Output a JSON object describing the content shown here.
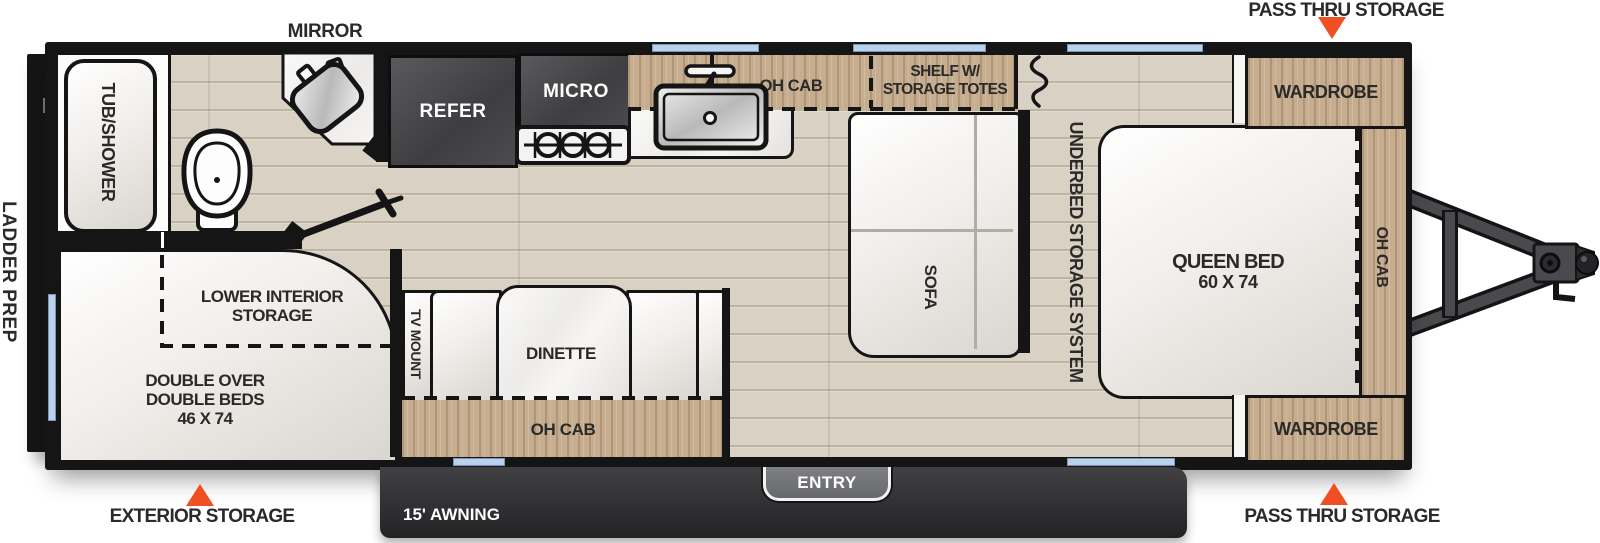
{
  "colors": {
    "accent_orange": "#F04E23",
    "window_blue": "#B9D3EE",
    "wall_black": "#151515",
    "floor_wood": "#D9D1C3",
    "cabinet_wood": "#C6AD90",
    "appliance_dark": "#4A4A4D",
    "awning_dark": "#39393C",
    "furniture_white": "#F6F4F2",
    "label_text": "#2B2A29"
  },
  "exterior": {
    "mirror_label": "MIRROR",
    "pass_thru_top_label": "PASS THRU STORAGE",
    "pass_thru_bottom_label": "PASS THRU STORAGE",
    "exterior_storage_label": "EXTERIOR STORAGE",
    "ladder_prep_label": "LADDER PREP",
    "awning_label": "15' AWNING",
    "entry_label": "ENTRY"
  },
  "interior": {
    "tub_shower": "TUB/SHOWER",
    "refer": "REFER",
    "micro": "MICRO",
    "kitchen_oh_cab": "OH CAB",
    "shelf_line1": "SHELF W/",
    "shelf_line2": "STORAGE TOTES",
    "sofa": "SOFA",
    "underbed_storage": "UNDERBED STORAGE SYSTEM",
    "queen_bed_line1": "QUEEN BED",
    "queen_bed_line2": "60 X 74",
    "wardrobe_top": "WARDROBE",
    "wardrobe_bottom": "WARDROBE",
    "bedroom_oh_cab": "OH CAB",
    "tv_mount": "TV MOUNT",
    "dinette": "DINETTE",
    "dinette_oh_cab": "OH CAB",
    "lower_storage_line1": "LOWER INTERIOR",
    "lower_storage_line2": "STORAGE",
    "bunk_line1": "DOUBLE OVER",
    "bunk_line2": "DOUBLE BEDS",
    "bunk_line3": "46 X 74"
  }
}
